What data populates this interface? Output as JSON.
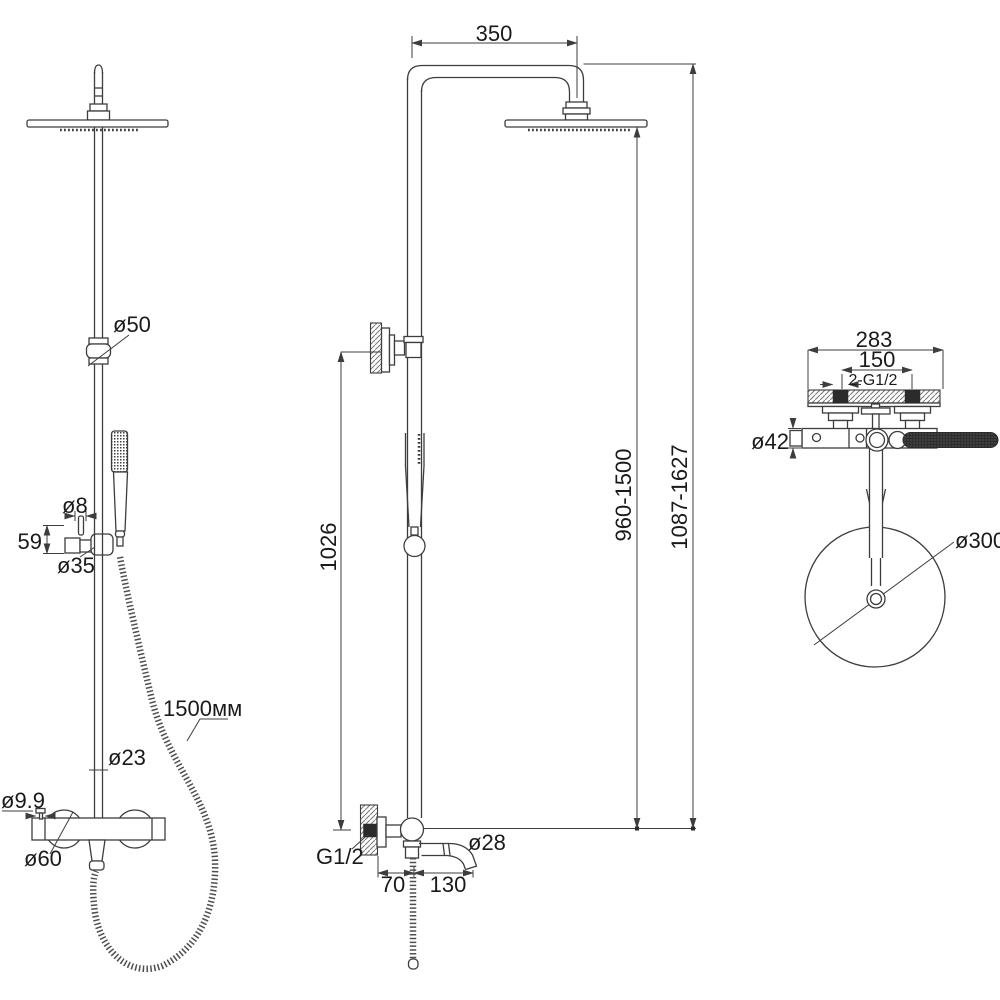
{
  "diagram": {
    "type": "technical-drawing",
    "subject": "shower-column-dimensional-drawing",
    "colors": {
      "background": "#ffffff",
      "line": "#3d3d3d",
      "dark_fill": "#2b2b2b",
      "text": "#1a1a1a"
    },
    "front_view": {
      "d50": "ø50",
      "d8": "ø8",
      "len59": "59",
      "d35": "ø35",
      "hose_length": "1500мм",
      "d23": "ø23",
      "d9_9": "ø9.9",
      "d60": "ø60"
    },
    "side_view": {
      "w350": "350",
      "h1026": "1026",
      "range_head": "960-1500",
      "range_total": "1087-1627",
      "thread": "G1/2",
      "d28": "ø28",
      "off70": "70",
      "off130": "130"
    },
    "top_view": {
      "w283": "283",
      "w150": "150",
      "thread_pair": "2-G1/2",
      "d42": "ø42",
      "d300": "ø300"
    }
  }
}
